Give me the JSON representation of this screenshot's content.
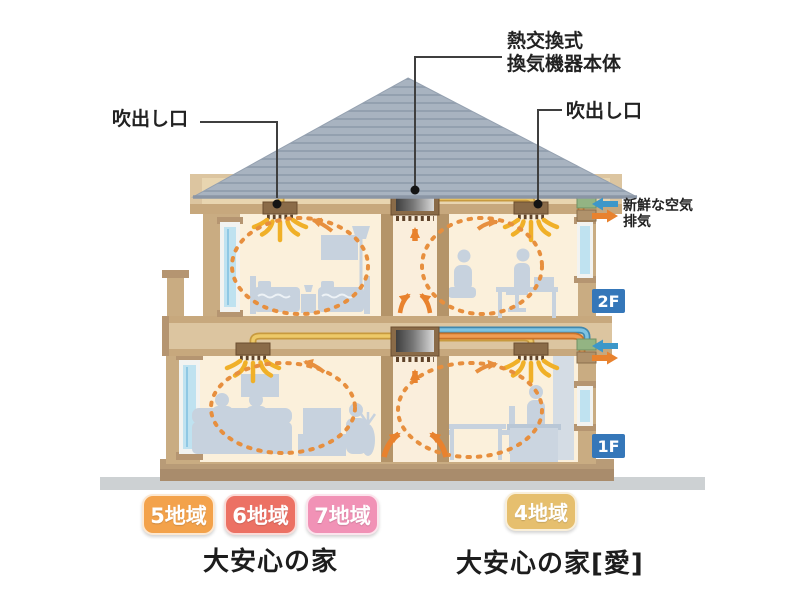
{
  "labels": {
    "outlet_left": "吹出し口",
    "heat_exchanger_line1": "熱交換式",
    "heat_exchanger_line2": "換気機器本体",
    "outlet_right": "吹出し口",
    "fresh_air": "新鮮な空気",
    "exhaust": "排気"
  },
  "floors": {
    "second": "2F",
    "first": "1F",
    "badge_color": "#3577B9"
  },
  "zones": {
    "left": [
      {
        "label": "5地域",
        "color": "#F3A24B"
      },
      {
        "label": "6地域",
        "color": "#EC7164"
      },
      {
        "label": "7地域",
        "color": "#F192B6"
      }
    ],
    "right": [
      {
        "label": "4地域",
        "color": "#E6BF6E"
      }
    ]
  },
  "products": {
    "left": "大安心の家",
    "right": "大安心の家[愛]"
  },
  "legend_colors": {
    "fresh_air_arrow": "#3D97C9",
    "exhaust_arrow": "#E8822E",
    "supply_duct": "#EDC968",
    "airflow": "#E78F3E"
  }
}
